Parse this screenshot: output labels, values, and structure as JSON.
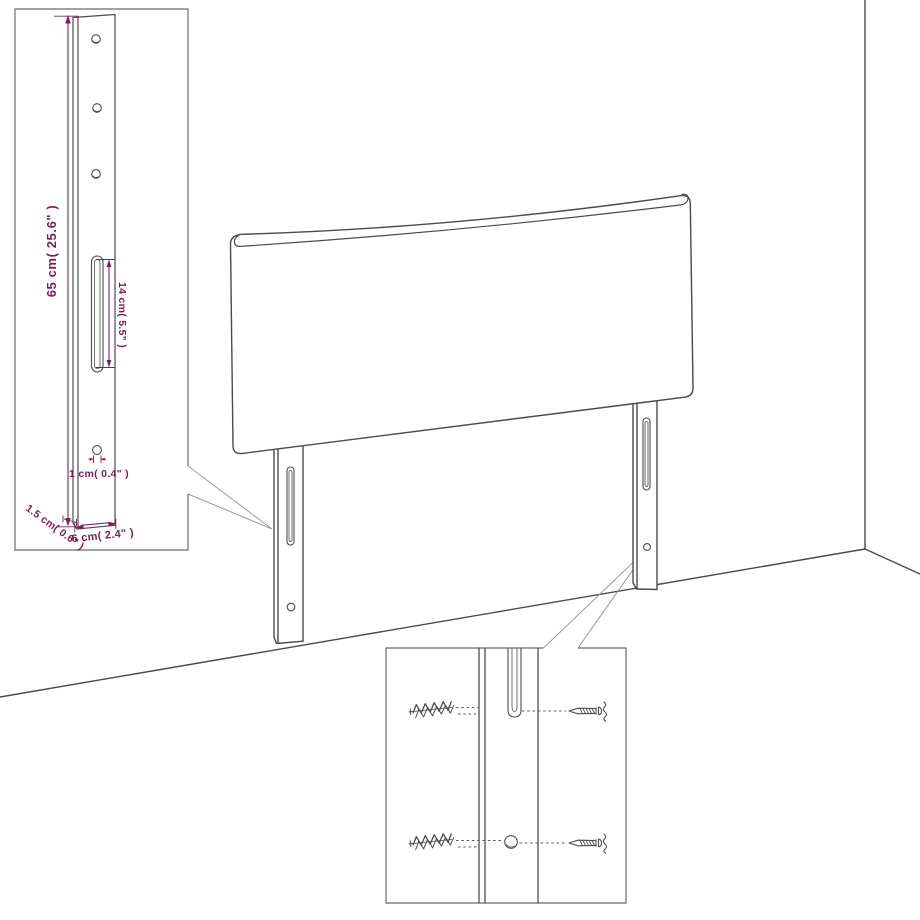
{
  "diagram": {
    "type": "furniture-assembly-diagram",
    "subject": "upholstered headboard with two wall-mount legs, dimension detail inset and wall-fixing (plug and screw) detail inset",
    "background_color": "#ffffff",
    "line_color": "#4a4a4a",
    "annotation_color": "#7a2059",
    "labels": {
      "post_height": "65 cm( 25.6\" )",
      "slot_length": "14 cm( 5.5\" )",
      "hole_diameter": "1 cm( 0.4\" )",
      "side_thickness": "1.5 cm( 0.6\" )",
      "post_width": "6 cm( 2.4\" )"
    }
  }
}
